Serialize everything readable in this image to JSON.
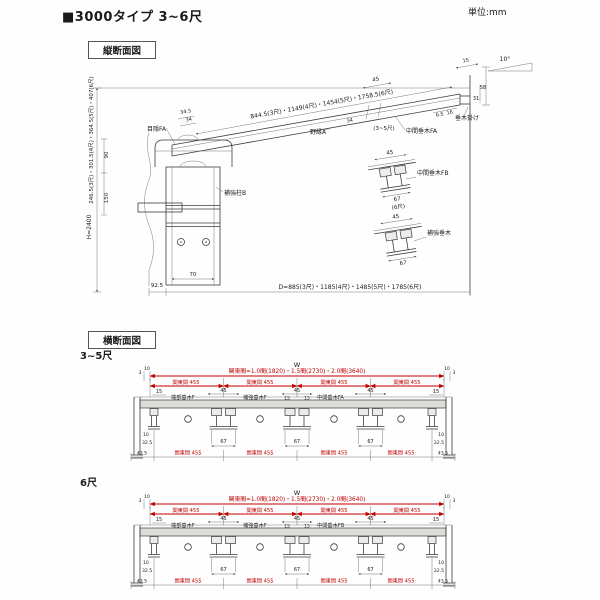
{
  "header": {
    "title": "■3000タイプ 3~6尺",
    "unit": "単位:mm"
  },
  "vs": {
    "box_label": "縦断面図",
    "angle": "10°",
    "height_dims": "246.5(3尺)・301.5(4尺)・364.5(5尺)・407(6尺)",
    "h_label": "H=2400",
    "dim_90": "90",
    "dim_150": "150",
    "slope_dims": "844.5(3尺)・1149(4尺)・1454(5尺)・1758.5(6尺)",
    "dim_34_5": "34.5",
    "dim_34": "34",
    "mekakushi": "目隠FA",
    "nobuchi": "野縁A",
    "mid": {
      "d45": "45",
      "d34": "34",
      "range": "(3~5尺)",
      "label": "中間垂木FA"
    },
    "tip": {
      "d15": "15",
      "d58": "58",
      "d31": "31",
      "d65": "6.5",
      "d16": "16",
      "label": "垂木掛け"
    },
    "post": "補強柱B",
    "d70": "70",
    "d925": "92.5",
    "depth_dims": "D=885(3尺)・1185(4尺)・1485(5尺)・1785(6尺)",
    "fb": {
      "d45": "45",
      "d67": "67",
      "size": "(6尺)",
      "label": "中間垂木FB"
    },
    "hk": {
      "d45": "45",
      "d67": "67",
      "label": "補強垂木"
    }
  },
  "cs": {
    "box_label": "横断面図",
    "w": "W",
    "width_dims": "関東間=1.0間(1820)・1.5間(2730)・2.0間(3640)",
    "span": "関東間 455",
    "d3": "3",
    "d10": "10",
    "d15": "15",
    "d45": "45",
    "d67": "67",
    "d325": "32.5",
    "d435": "43.5",
    "end_label": "端部垂木F",
    "reinforce_label": "補強垂木F"
  },
  "cs35": {
    "size": "3~5尺",
    "center": "中間垂木FA"
  },
  "cs6": {
    "size": "6尺",
    "center": "中間垂木FB"
  }
}
